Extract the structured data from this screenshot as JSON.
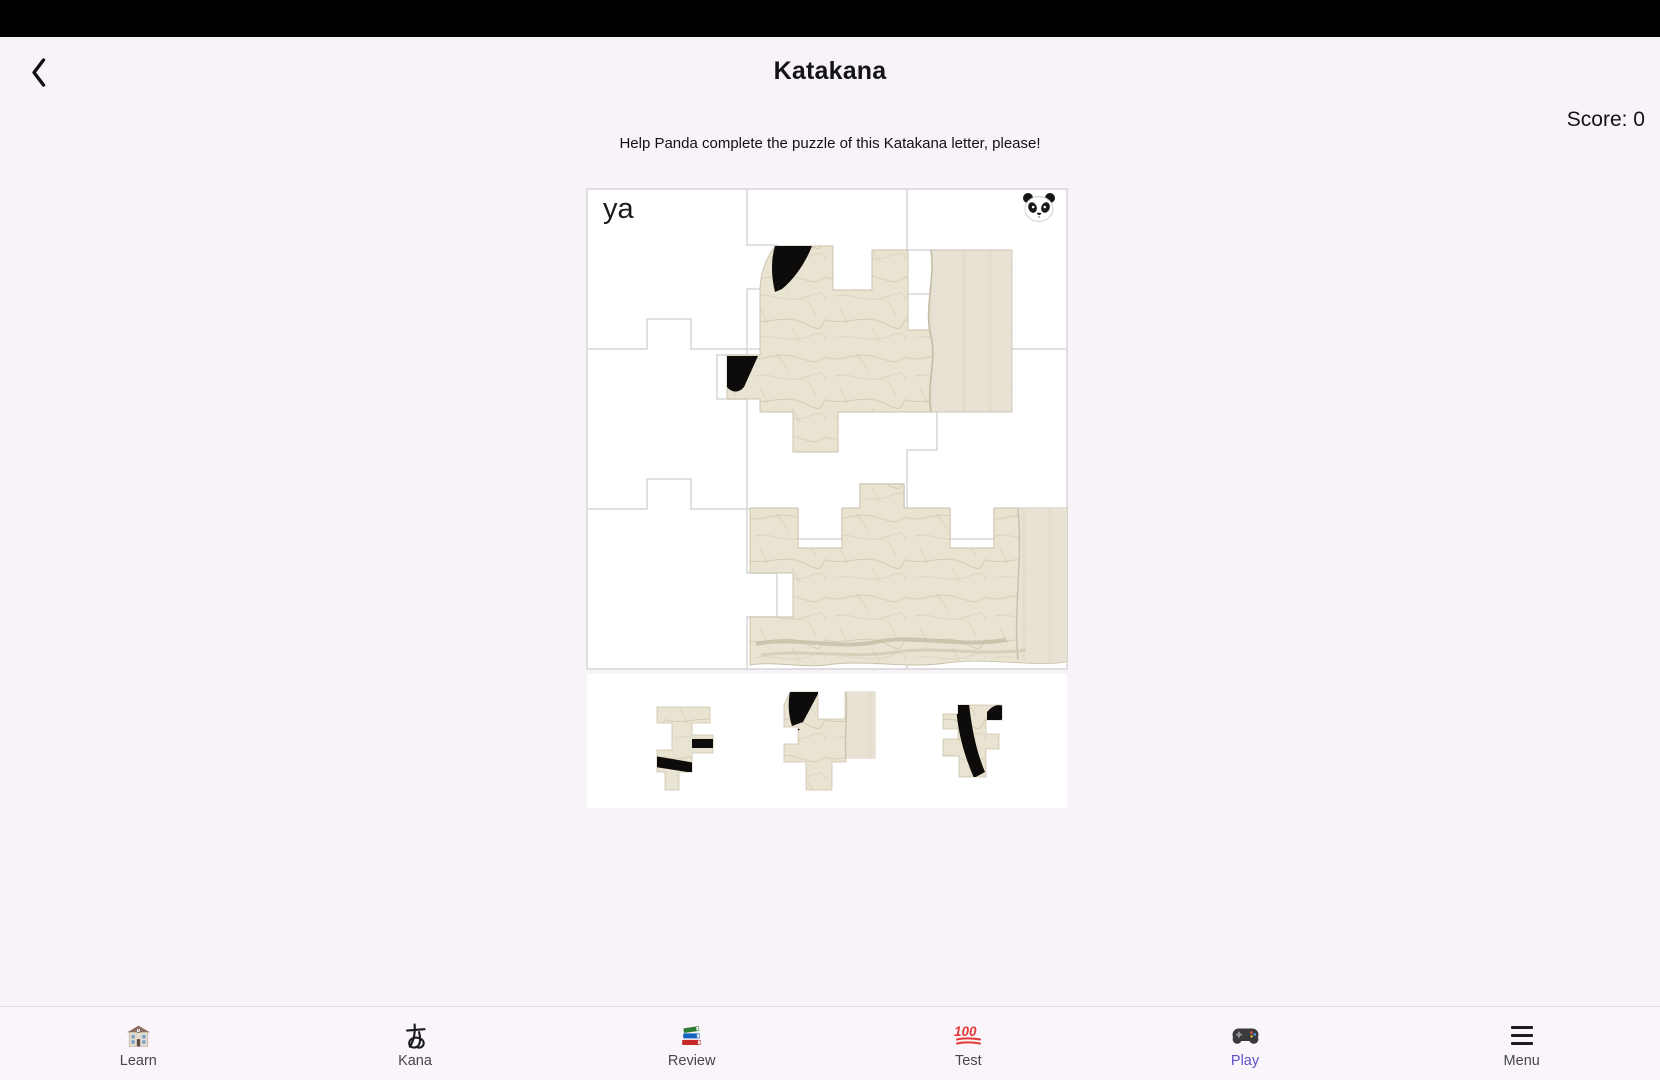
{
  "header": {
    "title": "Katakana",
    "back_icon": "chevron-left-icon",
    "score": "Score: 0"
  },
  "instruction": "Help Panda complete the puzzle of this Katakana letter, please!",
  "puzzle": {
    "kana_label": "ya",
    "helper_icon": "panda-icon",
    "grid": {
      "rows": 3,
      "cols": 3
    },
    "placed_piece_groups": 2,
    "tray_piece_count": 3
  },
  "nav": {
    "items": [
      {
        "label": "Learn",
        "icon": "school-icon",
        "active": false
      },
      {
        "label": "Kana",
        "icon": "kana-a-icon",
        "active": false
      },
      {
        "label": "Review",
        "icon": "books-icon",
        "active": false
      },
      {
        "label": "Test",
        "icon": "hundred-points-icon",
        "active": false
      },
      {
        "label": "Play",
        "icon": "gamepad-icon",
        "active": true
      },
      {
        "label": "Menu",
        "icon": "menu-icon",
        "active": false
      }
    ]
  },
  "colors": {
    "background": "#f8f2f9",
    "status_bar": "#000000",
    "card": "#ffffff",
    "grid_line": "#d7d7d7",
    "paper": "#e9e3d2",
    "ink": "#0d0c0a",
    "active_nav": "#5a52c7",
    "inactive_nav": "#47474b"
  }
}
